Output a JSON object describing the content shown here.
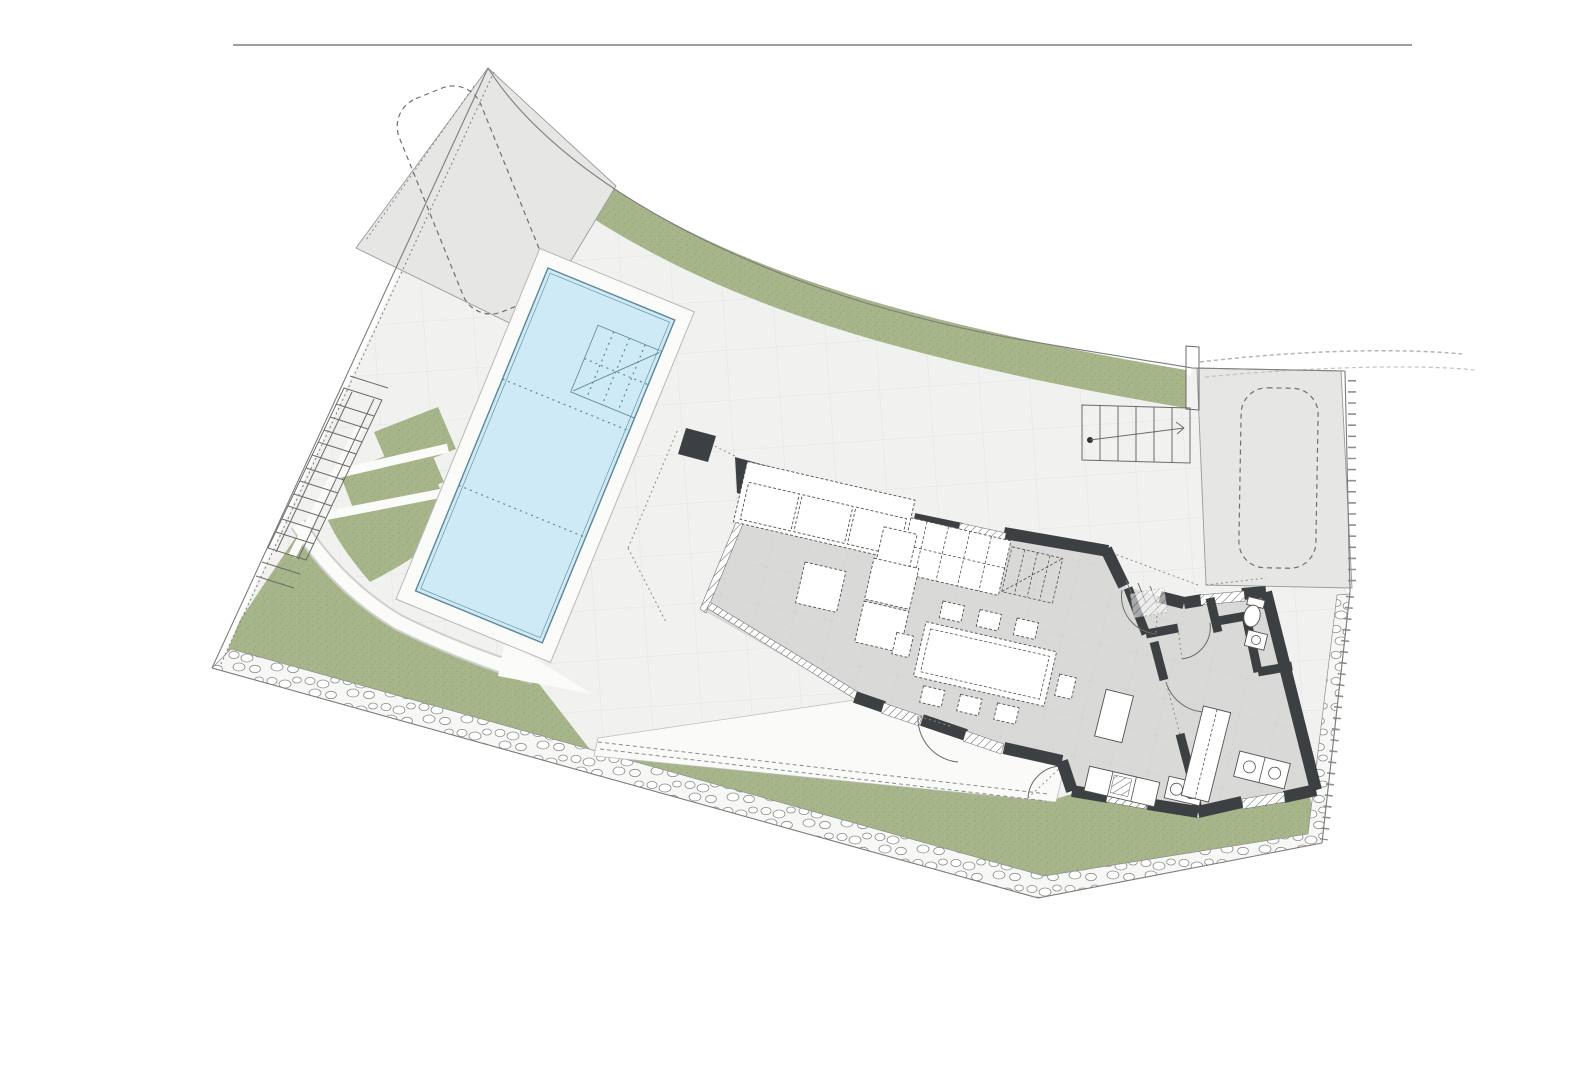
{
  "document": {
    "label": "architectural-site-plan-ground-floor",
    "type": "floor-plan-drawing"
  },
  "colors": {
    "page_bg": "#ffffff",
    "terrace": "#f1f1ef",
    "tile_line": "#e4e4e2",
    "site_boundary": "#7d7d7b",
    "rule_line": "#9e9e9c",
    "green": "#a7b58a",
    "green_dot": "#95a478",
    "pad": "#e6e6e4",
    "pad_line": "#9a9a98",
    "car_dash": "#6f6f6d",
    "pool_water": "#cdeaf6",
    "pool_line": "#5d8796",
    "deck": "#fbfbf9",
    "deck_line": "#b8b8b6",
    "stone_line": "#8f8f8d",
    "wall": "#3d4043",
    "floor": "#d9d9d7",
    "floor_line": "#c9c9c7",
    "furn_line": "#55504e",
    "dash_line": "#8c8c8a",
    "stair_line": "#6b6b69"
  },
  "features": {
    "site": "site-boundary",
    "pool": "swimming-pool",
    "house": "house-walls",
    "garden": "lawn-areas",
    "parking_left": "parking-pad-left",
    "parking_right": "parking-pad-right",
    "stairs_left": "exterior-stairs-left",
    "stairs_right": "exterior-stairs-right",
    "stone": "stone-retaining-band"
  }
}
